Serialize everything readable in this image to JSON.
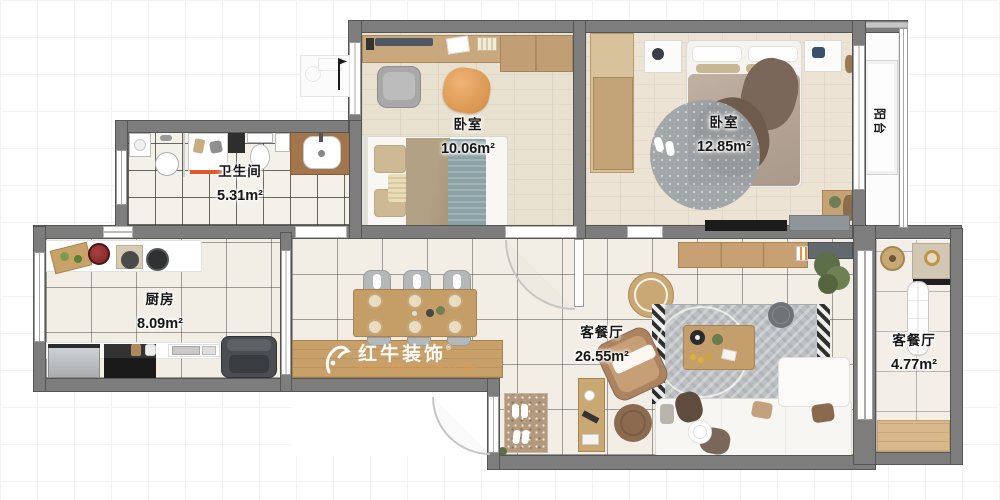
{
  "watermark": {
    "brand": "红牛装饰",
    "subtitle": "HONG NIU DECORATION",
    "registered": "®"
  },
  "rooms": {
    "bedroom1": {
      "label": "卧室",
      "area": "10.06m²"
    },
    "bedroom2": {
      "label": "卧室",
      "area": "12.85m²"
    },
    "bathroom": {
      "label": "卫生间",
      "area": "5.31m²"
    },
    "kitchen": {
      "label": "厨房",
      "area": "8.09m²"
    },
    "living": {
      "label": "客餐厅",
      "area": "26.55m²"
    },
    "side_room": {
      "label": "客餐厅",
      "area": "4.77m²"
    },
    "balcony": {
      "label": "阳台"
    }
  },
  "colors": {
    "wall": "#7d7d7d",
    "wood_floor": "#e9e1d0",
    "tile_floor": "#f2eee5",
    "furniture_wood": "#c9a36e",
    "watermark_text": "#ffffff",
    "watermark_sub": "#eb9646"
  }
}
